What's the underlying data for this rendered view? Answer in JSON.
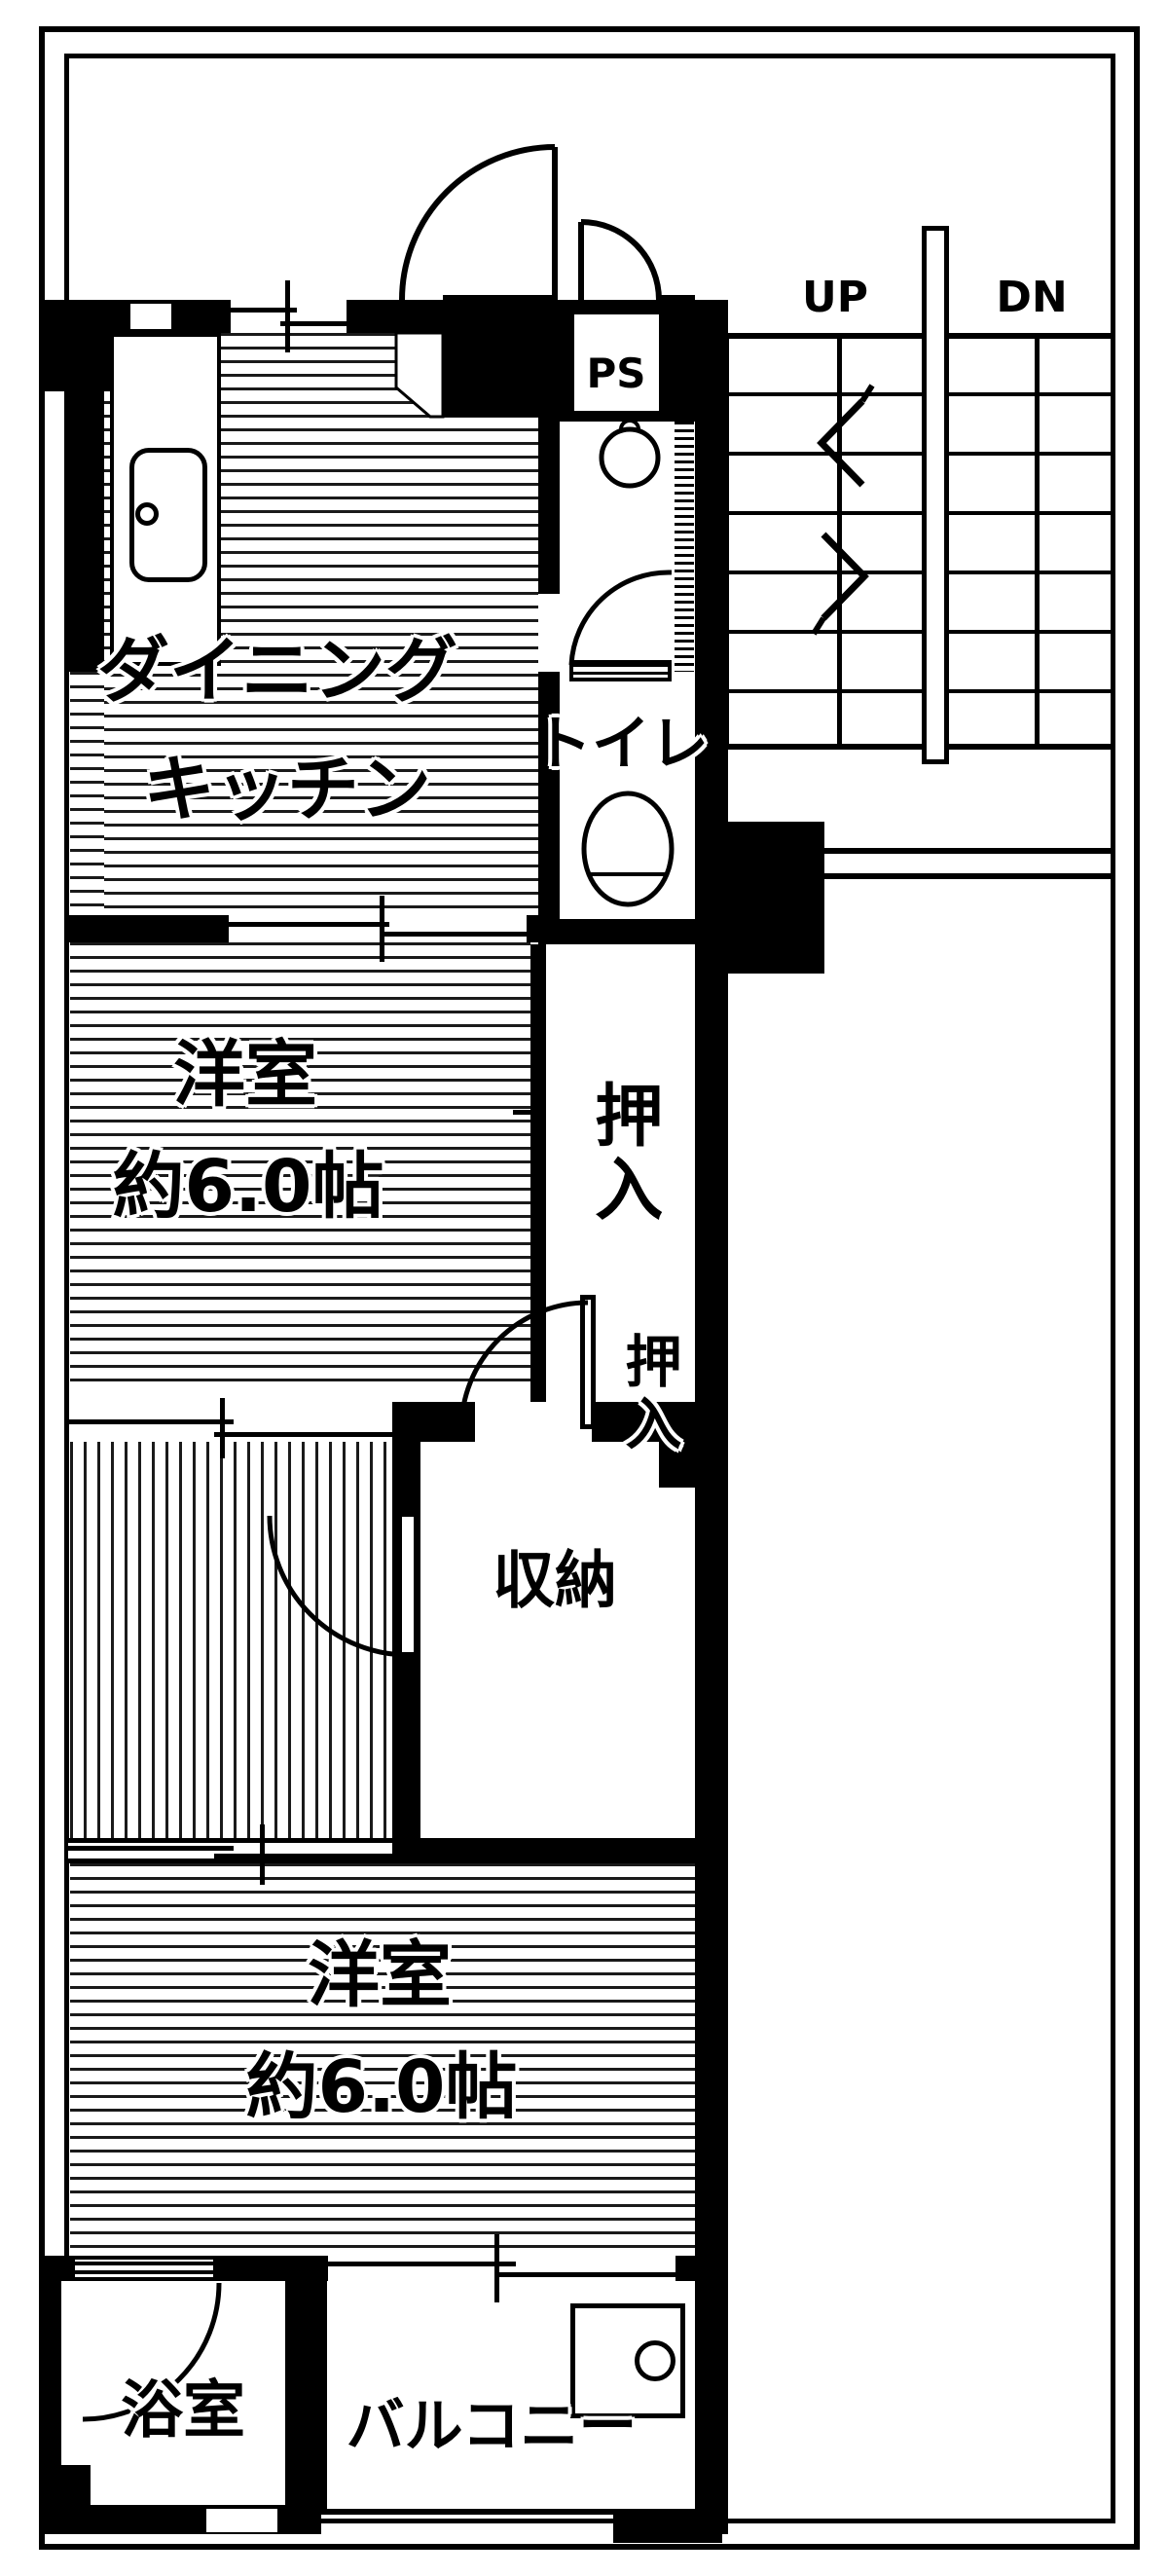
{
  "document": {
    "type": "japanese-apartment-floor-plan",
    "colors": {
      "ink": "#000000",
      "paper": "#ffffff"
    }
  },
  "stairwell": {
    "up_label": "UP",
    "dn_label": "DN"
  },
  "rooms": {
    "pipe_space": {
      "label": "PS"
    },
    "dining_kitchen": {
      "label_line1": "ダイニング",
      "label_line2": "キッチン"
    },
    "toilet": {
      "label": "トイレ"
    },
    "western_room_1": {
      "label": "洋室",
      "size": "約6.0帖"
    },
    "closet_upper": {
      "label": "押入"
    },
    "closet_lower": {
      "label": "押入"
    },
    "storage": {
      "label": "収納"
    },
    "western_room_2": {
      "label": "洋室",
      "size": "約6.0帖"
    },
    "bathroom": {
      "label": "浴室"
    },
    "balcony": {
      "label": "バルコニー"
    }
  }
}
